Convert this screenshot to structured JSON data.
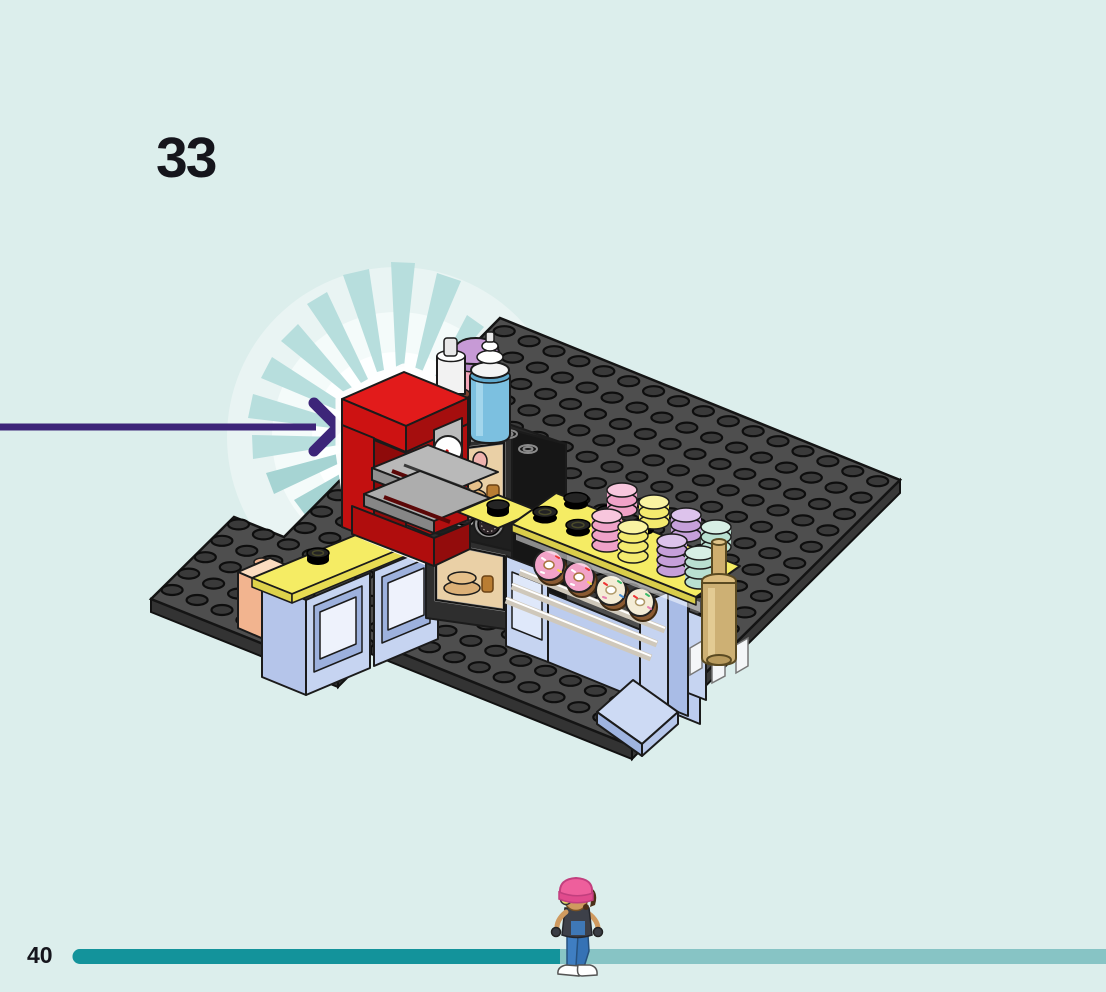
{
  "page": {
    "step_number": "33",
    "page_number": "40",
    "background_color": "#dceeec",
    "text_color": "#15151c"
  },
  "progress_bar": {
    "completed_color": "#13939b",
    "remaining_color": "#87c4c5",
    "completed_percent": 47
  },
  "callout": {
    "arrow_color": "#3d2579",
    "burst_ray_color": "#b7dedd",
    "burst_glow_color": "#fdffff"
  },
  "build": {
    "description": "Isometric LEGO bakery counter assembly on black studded baseplates",
    "baseplate_color": "#4e4e4e",
    "stud_color": "#3a3a3a",
    "parts": {
      "coffee_machine": {
        "body_color": "#cd1212",
        "panel_color": "#bcbcbc",
        "gauge": "white dial with red needle"
      },
      "oven": {
        "body_color": "#2e2e2e",
        "window_color": "#ead0a6",
        "contents": "baked bread and toast",
        "dial_count": 3
      },
      "syrup_bottles": [
        {
          "name": "brown-syrup-bottle",
          "body_color": "#6b3a24",
          "cap_color": "#f2f2f2"
        },
        {
          "name": "pink-syrup-bottle",
          "body_color": "#e87f98",
          "cap_color": "#c79ad6"
        },
        {
          "name": "blue-cream-bottle",
          "body_color": "#7cc0e0",
          "cap_color": "#ffffff"
        }
      ],
      "counter": {
        "top_color": "#f5ec64",
        "cabinet_color": "#c6d4f1",
        "corner_brick_color": "#f6c9a6",
        "round_tile_color": "#1d1d1d"
      },
      "macarons": [
        {
          "name": "pink-macaron-stack",
          "color": "#f0a2c8"
        },
        {
          "name": "yellow-macaron-stack",
          "color": "#f3ea6f"
        },
        {
          "name": "lavender-macaron-stack",
          "color": "#c6a0da"
        },
        {
          "name": "mint-macaron-stack",
          "color": "#b9e0d1"
        }
      ],
      "donuts": [
        {
          "name": "pink-sprinkle-donut",
          "frosting_color": "#f2a3c8"
        },
        {
          "name": "pink-sprinkle-donut",
          "frosting_color": "#f2a3c8"
        },
        {
          "name": "white-sprinkle-donut",
          "frosting_color": "#f4ecd6"
        },
        {
          "name": "white-sprinkle-donut",
          "frosting_color": "#f4ecd6"
        }
      ],
      "rolling_pin_color": "#cdb074",
      "ramp_color": "#cddaf4"
    }
  },
  "mascot": {
    "description": "builder character standing on the progress bar",
    "beanie_color": "#ee5f9c",
    "skin_color": "#cf9a5f",
    "top_color": "#3d4049",
    "pants_color": "#3c7cc0",
    "shoe_color": "#ffffff"
  }
}
